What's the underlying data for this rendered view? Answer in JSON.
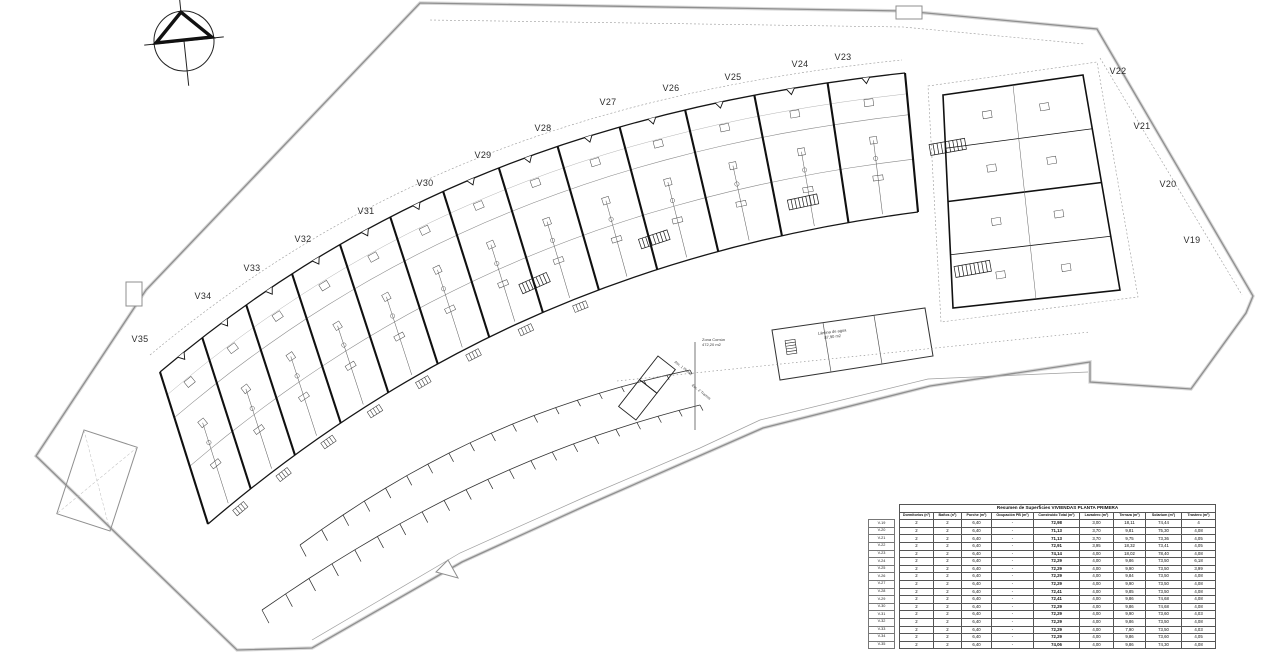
{
  "plan": {
    "unit_labels": [
      "V23",
      "V24",
      "V25",
      "V26",
      "V27",
      "V28",
      "V29",
      "V30",
      "V31",
      "V32",
      "V33",
      "V34",
      "V35",
      "V22",
      "V21",
      "V20",
      "V19"
    ],
    "annotations": {
      "zona_comun": [
        "Zona Común",
        "472,20 m2"
      ],
      "lamina": [
        "Lámina de agua",
        "87,90 m2"
      ],
      "asc": "Asc. 1 Planta",
      "esc": "Esc. 2 Tramos"
    }
  },
  "table": {
    "title": "Resumen de Superficies VIVIENDAS PLANTA PRIMERA",
    "columns": [
      "Dormitorios (nº)",
      "Baños (nº)",
      "Porche (m²)",
      "Ocupación PB (m²)",
      "Construido Total (m²)",
      "Lavadero (m²)",
      "Terraza (m²)",
      "Solarium (m²)",
      "Trastero (m²)"
    ],
    "rows": [
      {
        "label": "V-19",
        "values": [
          "2",
          "2",
          "6,40",
          "-",
          "72,98",
          "3,00",
          "18,11",
          "74,44",
          "4"
        ]
      },
      {
        "label": "V-20",
        "values": [
          "2",
          "2",
          "6,40",
          "-",
          "71,13",
          "3,70",
          "9,81",
          "75,30",
          "4,08"
        ]
      },
      {
        "label": "V-21",
        "values": [
          "2",
          "2",
          "6,40",
          "-",
          "71,13",
          "3,70",
          "9,75",
          "73,36",
          "4,05"
        ]
      },
      {
        "label": "V-22",
        "values": [
          "2",
          "2",
          "6,40",
          "-",
          "72,91",
          "3,95",
          "18,32",
          "73,41",
          "4,05"
        ]
      },
      {
        "label": "V-23",
        "values": [
          "2",
          "2",
          "6,40",
          "-",
          "74,14",
          "4,00",
          "18,02",
          "78,40",
          "4,08"
        ]
      },
      {
        "label": "V-24",
        "values": [
          "2",
          "2",
          "6,40",
          "-",
          "72,29",
          "4,00",
          "9,86",
          "73,50",
          "6,18"
        ]
      },
      {
        "label": "V-25",
        "values": [
          "2",
          "2",
          "6,40",
          "-",
          "72,29",
          "4,00",
          "9,90",
          "73,50",
          "3,99"
        ]
      },
      {
        "label": "V-26",
        "values": [
          "2",
          "2",
          "6,40",
          "-",
          "72,29",
          "4,00",
          "9,84",
          "73,50",
          "4,08"
        ]
      },
      {
        "label": "V-27",
        "values": [
          "2",
          "2",
          "6,40",
          "-",
          "72,29",
          "4,00",
          "9,90",
          "73,50",
          "4,08"
        ]
      },
      {
        "label": "V-28",
        "values": [
          "2",
          "2",
          "6,40",
          "-",
          "72,41",
          "4,00",
          "9,85",
          "73,50",
          "4,08"
        ]
      },
      {
        "label": "V-29",
        "values": [
          "2",
          "2",
          "6,40",
          "-",
          "72,41",
          "4,00",
          "9,86",
          "74,68",
          "4,08"
        ]
      },
      {
        "label": "V-30",
        "values": [
          "2",
          "2",
          "6,40",
          "-",
          "72,29",
          "4,00",
          "9,86",
          "74,68",
          "4,08"
        ]
      },
      {
        "label": "V-31",
        "values": [
          "2",
          "2",
          "6,40",
          "-",
          "72,29",
          "4,00",
          "9,90",
          "73,60",
          "4,03"
        ]
      },
      {
        "label": "V-32",
        "values": [
          "2",
          "2",
          "6,40",
          "-",
          "72,29",
          "4,00",
          "9,86",
          "73,50",
          "4,08"
        ]
      },
      {
        "label": "V-33",
        "values": [
          "2",
          "2",
          "6,40",
          "-",
          "72,29",
          "4,00",
          "7,90",
          "73,50",
          "4,03"
        ]
      },
      {
        "label": "V-34",
        "values": [
          "2",
          "2",
          "6,40",
          "-",
          "72,29",
          "4,00",
          "9,86",
          "73,60",
          "4,05"
        ]
      },
      {
        "label": "V-35",
        "values": [
          "2",
          "2",
          "6,40",
          "-",
          "74,06",
          "4,00",
          "9,86",
          "74,30",
          "4,08"
        ]
      }
    ],
    "total_label": "TOTAL PP",
    "totals": {
      "construido_total": "1233,80",
      "trastero": "68,7"
    }
  }
}
